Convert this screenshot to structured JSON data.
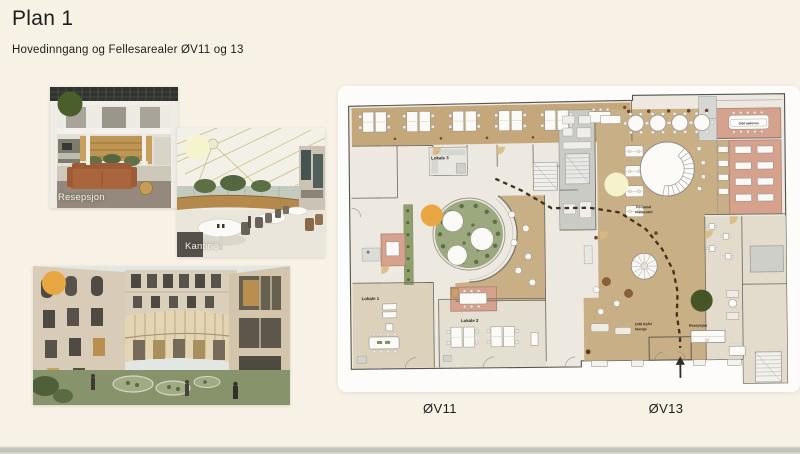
{
  "slide": {
    "title": "Plan 1",
    "subtitle": "Hovedinngang og Fellesarealer ØV11 og 13",
    "background": "#F8F1E6"
  },
  "photos": {
    "resepsjon": {
      "caption": "Resepsjon",
      "marker_color": "#4A5E2A"
    },
    "kantine": {
      "caption": "Kantine",
      "marker_color": "#F5F4CF"
    },
    "courtyard": {
      "marker_color": "#E8A742"
    }
  },
  "plan": {
    "labels": {
      "lokale1": "Lokale 1",
      "lokale2": "Lokale 2",
      "lokale3": "Lokale 3",
      "restaurant1": "Personal",
      "restaurant2": "restaurant",
      "moterom": "Odd møterom",
      "kafe1": "Odd Kafe/",
      "kafe2": "lounge",
      "resepsjon": "Resepsjon"
    },
    "markers": {
      "courtyard": "#E8A742",
      "kantine": "#F4F3CC",
      "resepsjon": "#465526"
    },
    "buildings": {
      "ov11": "ØV11",
      "ov13": "ØV13"
    }
  }
}
